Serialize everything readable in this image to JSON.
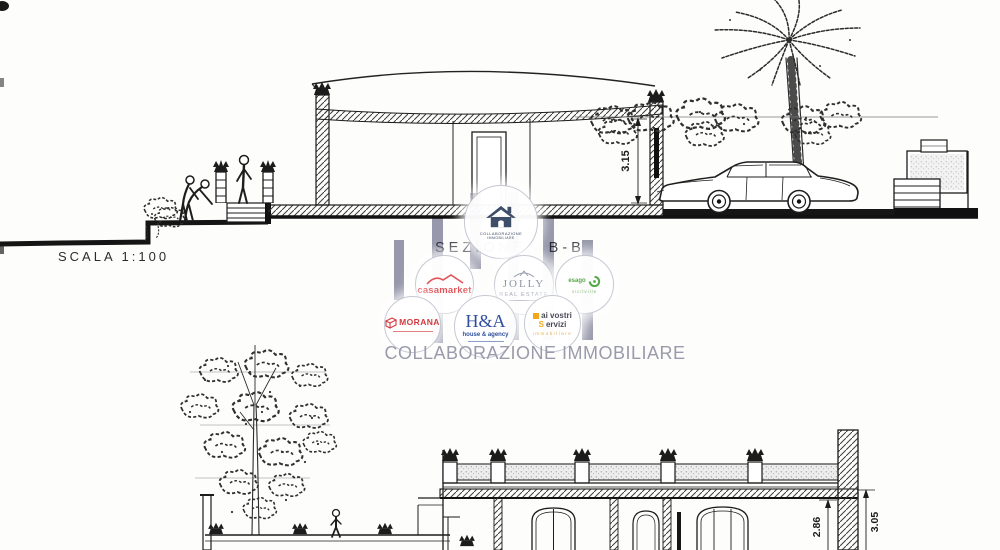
{
  "top_drawing": {
    "scale_label": "SCALA 1:100",
    "section_label": "SEZIONE B-B",
    "dim_interior_height": "3.15"
  },
  "bottom_drawing": {
    "dim_left": "2.86",
    "dim_right": "3.05"
  },
  "watermark": {
    "title": "COLLABORAZIONE IMMOBILIARE",
    "bar_color": "#8f90a6",
    "center_logo": {
      "line1": "COLLABORAZIONE",
      "line2": "IMMOBILIARE",
      "icon_color": "#3e4d68"
    },
    "agencies": [
      {
        "id": "casamarket",
        "line1": "casamarket",
        "color": "#e0555a"
      },
      {
        "id": "jolly-real-estate",
        "line1": "JOLLY",
        "line2": "REAL ESTATE",
        "color": "#8d93a3"
      },
      {
        "id": "esago",
        "line1": "esago",
        "line2": "sicilville",
        "color": "#55a847"
      },
      {
        "id": "morana",
        "line1": "MORANA",
        "color": "#d33b3f"
      },
      {
        "id": "h-a-house-agency",
        "line1": "H&A",
        "line2": "house & agency",
        "color": "#2f4f9e"
      },
      {
        "id": "ai-vostri-servizi",
        "line1": "ai vostri",
        "accent_letter": "S",
        "line2_rest": "ervizi",
        "line3": "immobiliare",
        "color": "#4a4a55",
        "accent": "#f0a818"
      }
    ]
  }
}
